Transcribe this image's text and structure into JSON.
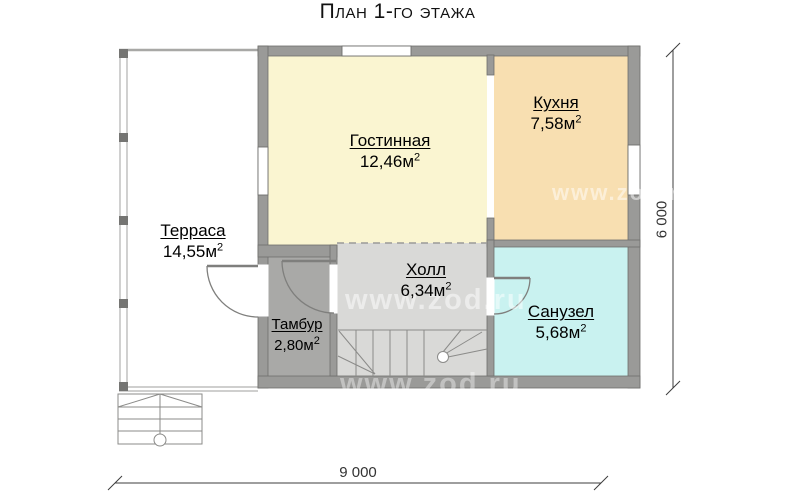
{
  "title": "План 1-го этажа",
  "watermark": "www.zod.ru",
  "rooms": [
    {
      "id": "terrace",
      "name": "Терраса",
      "area": "14,55м",
      "sup": "2"
    },
    {
      "id": "living",
      "name": "Гостинная",
      "area": "12,46м",
      "sup": "2"
    },
    {
      "id": "kitchen",
      "name": "Кухня",
      "area": "7,58м",
      "sup": "2"
    },
    {
      "id": "hall",
      "name": "Холл",
      "area": "6,34м",
      "sup": "2"
    },
    {
      "id": "tambour",
      "name": "Тамбур",
      "area": "2,80м",
      "sup": "2"
    },
    {
      "id": "bathroom",
      "name": "Санузел",
      "area": "5,68м",
      "sup": "2"
    }
  ],
  "dimensions": {
    "horizontal": "9 000",
    "vertical": "6 000"
  },
  "colors": {
    "wall": "#9a9a98",
    "wall-edge": "#6f6f6d",
    "living": "#faf5d1",
    "kitchen": "#f8dfb1",
    "hall": "#d9d9d7",
    "tambour": "#a9a9a7",
    "bathroom": "#c9f2f0",
    "line": "#8b8b89",
    "dim": "#3c3c3c"
  }
}
